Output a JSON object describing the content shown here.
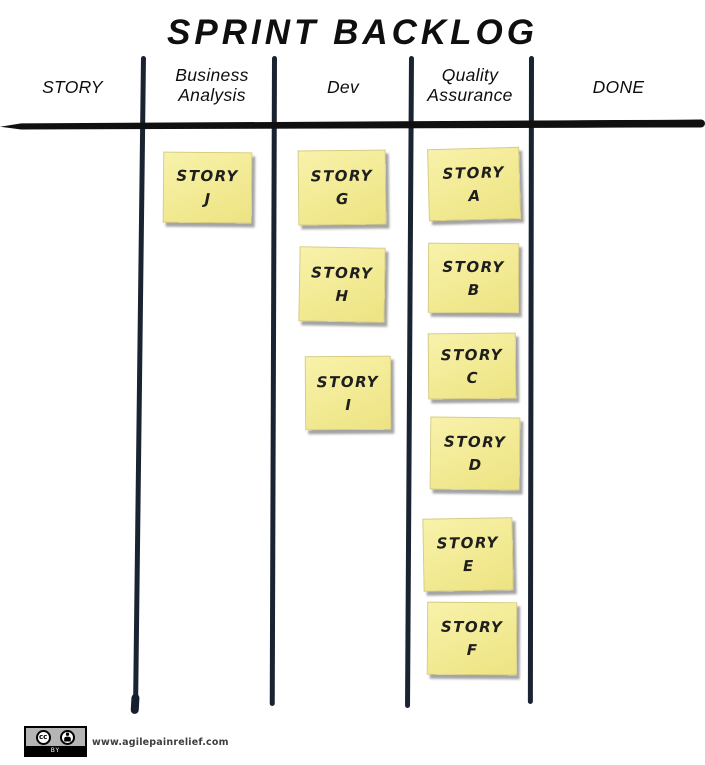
{
  "title": "SPRINT BACKLOG",
  "columns": [
    {
      "label": "STORY"
    },
    {
      "label": "Business Analysis"
    },
    {
      "label": "Dev"
    },
    {
      "label": "Quality Assurance"
    },
    {
      "label": "DONE"
    }
  ],
  "notes": [
    {
      "column": "Business Analysis",
      "line1": "STORY",
      "line2": "J"
    },
    {
      "column": "Dev",
      "line1": "STORY",
      "line2": "G"
    },
    {
      "column": "Dev",
      "line1": "STORY",
      "line2": "H"
    },
    {
      "column": "Dev",
      "line1": "STORY",
      "line2": "I"
    },
    {
      "column": "Quality Assurance",
      "line1": "STORY",
      "line2": "A"
    },
    {
      "column": "Quality Assurance",
      "line1": "STORY",
      "line2": "B"
    },
    {
      "column": "Quality Assurance",
      "line1": "STORY",
      "line2": "C"
    },
    {
      "column": "Quality Assurance",
      "line1": "STORY",
      "line2": "D"
    },
    {
      "column": "Quality Assurance",
      "line1": "STORY",
      "line2": "E"
    },
    {
      "column": "Quality Assurance",
      "line1": "STORY",
      "line2": "F"
    }
  ],
  "footer": {
    "cc_label": "cc",
    "by_label": "BY",
    "website": "www.agilepainrelief.com"
  },
  "colors": {
    "note_fill": "#f3ec96",
    "board_line": "#1b2433",
    "ink": "#141414"
  }
}
